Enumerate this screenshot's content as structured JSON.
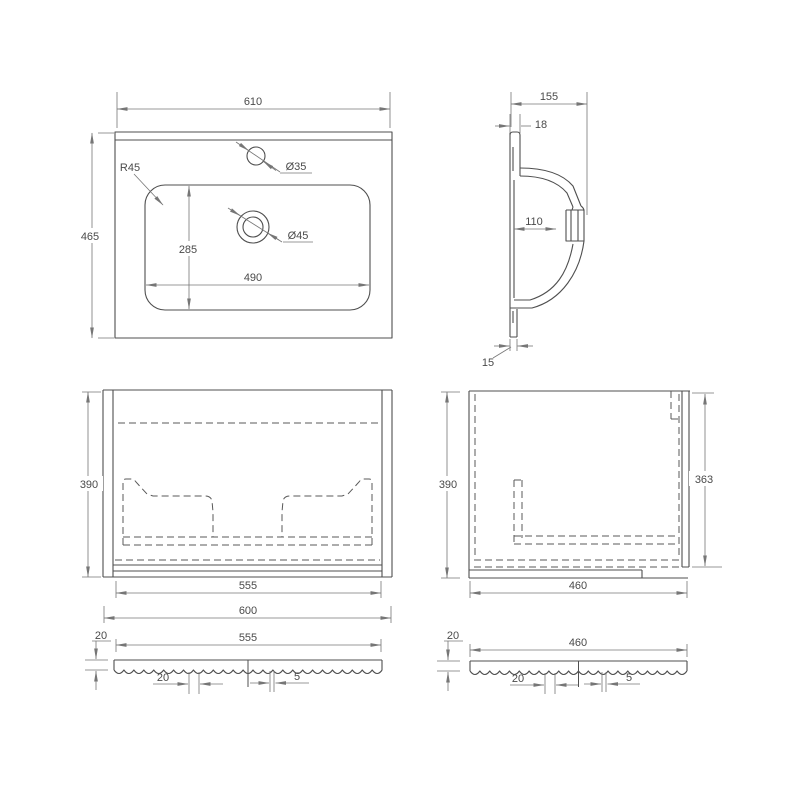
{
  "drawing": {
    "washbasin_top_view": {
      "width": "610",
      "depth": "465",
      "corner_radius": "R45",
      "faucet_hole_diameter": "Ø35",
      "drain_hole_diameter": "Ø45",
      "basin_inner_depth": "285",
      "basin_inner_width": "490"
    },
    "washbasin_side_section": {
      "total_depth": "155",
      "front_lip_thickness": "18",
      "inner_depth": "110",
      "bottom_lip_thickness": "15"
    },
    "cabinet_front_view": {
      "height": "390",
      "inner_width": "555",
      "outer_width": "600"
    },
    "cabinet_side_view": {
      "height": "390",
      "inner_height": "363",
      "depth": "460"
    },
    "front_panel_section": {
      "thickness": "20",
      "width": "555",
      "groove_spacing": "20",
      "groove_width": "5"
    },
    "side_panel_section": {
      "thickness": "20",
      "width": "460",
      "groove_spacing": "20",
      "groove_width": "5"
    }
  }
}
